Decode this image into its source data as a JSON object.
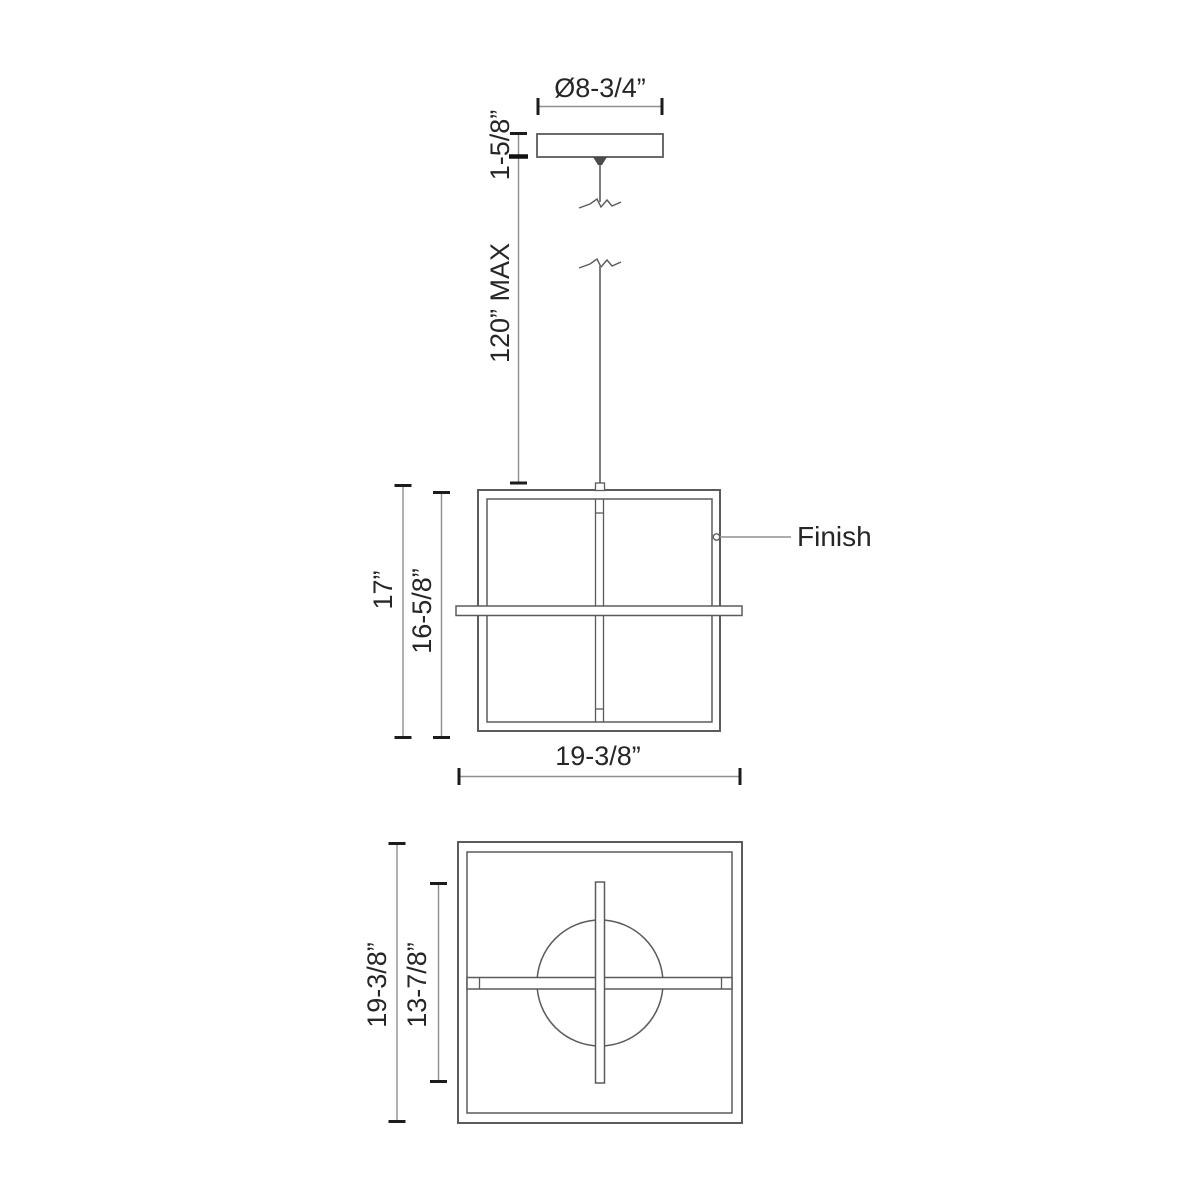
{
  "colors": {
    "background": "#ffffff",
    "object_line": "#5b5b5b",
    "dimension_line": "#8f8f8f",
    "tick": "#1c1c1c",
    "text": "#262626"
  },
  "views": {
    "canopy": {
      "dims": {
        "diameter": "Ø8-3/4”",
        "canopy_height": "1-5/8”",
        "suspension_max": "120” MAX"
      }
    },
    "front": {
      "dims": {
        "overall_height": "17”",
        "frame_height": "16-5/8”",
        "overall_width": "19-3/8”"
      },
      "labels": {
        "finish": "Finish"
      }
    },
    "bottom": {
      "dims": {
        "overall_depth": "19-3/8”",
        "inner_span": "13-7/8”"
      }
    }
  }
}
